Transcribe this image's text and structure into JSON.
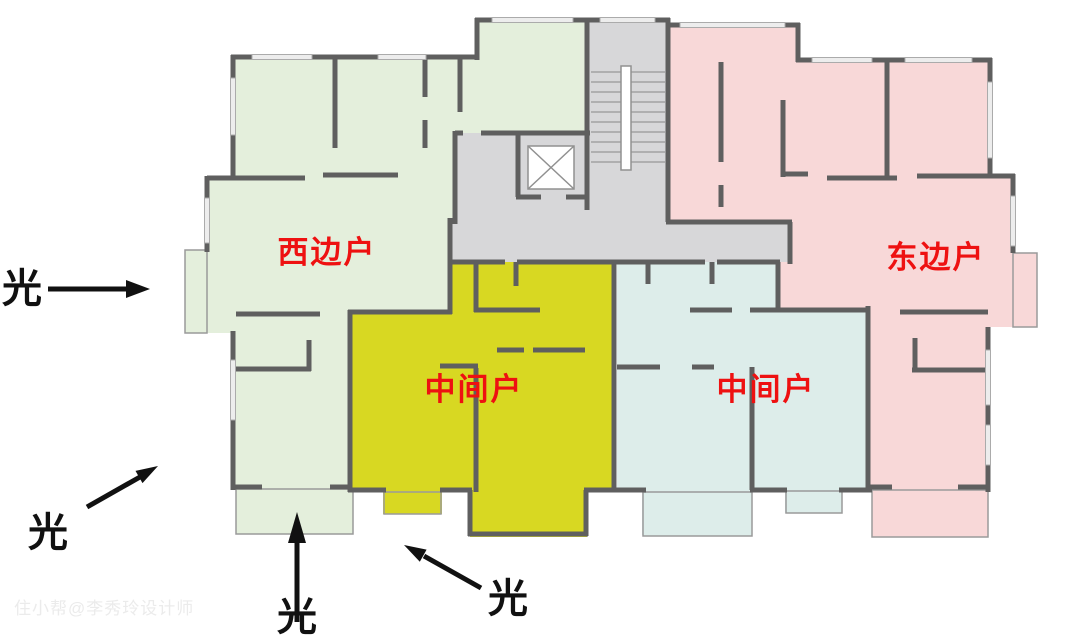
{
  "colors": {
    "west_fill": "#e4efdc",
    "east_fill": "#f8d8d8",
    "middle_left_fill": "#d8d822",
    "middle_right_fill": "#ddedea",
    "core_fill": "#d7d7d9",
    "wall": "#5f5f5f",
    "label_red": "#ee1111",
    "annotation_black": "#111111"
  },
  "units": {
    "west": {
      "label": "西边户"
    },
    "east": {
      "label": "东边户"
    },
    "middle_left": {
      "label": "中间户"
    },
    "middle_right": {
      "label": "中间户"
    }
  },
  "annotations": {
    "light_west": "光",
    "light_southwest": "光",
    "light_south": "光",
    "light_south_center": "光"
  },
  "watermark": "住小帮@李秀玲设计师"
}
